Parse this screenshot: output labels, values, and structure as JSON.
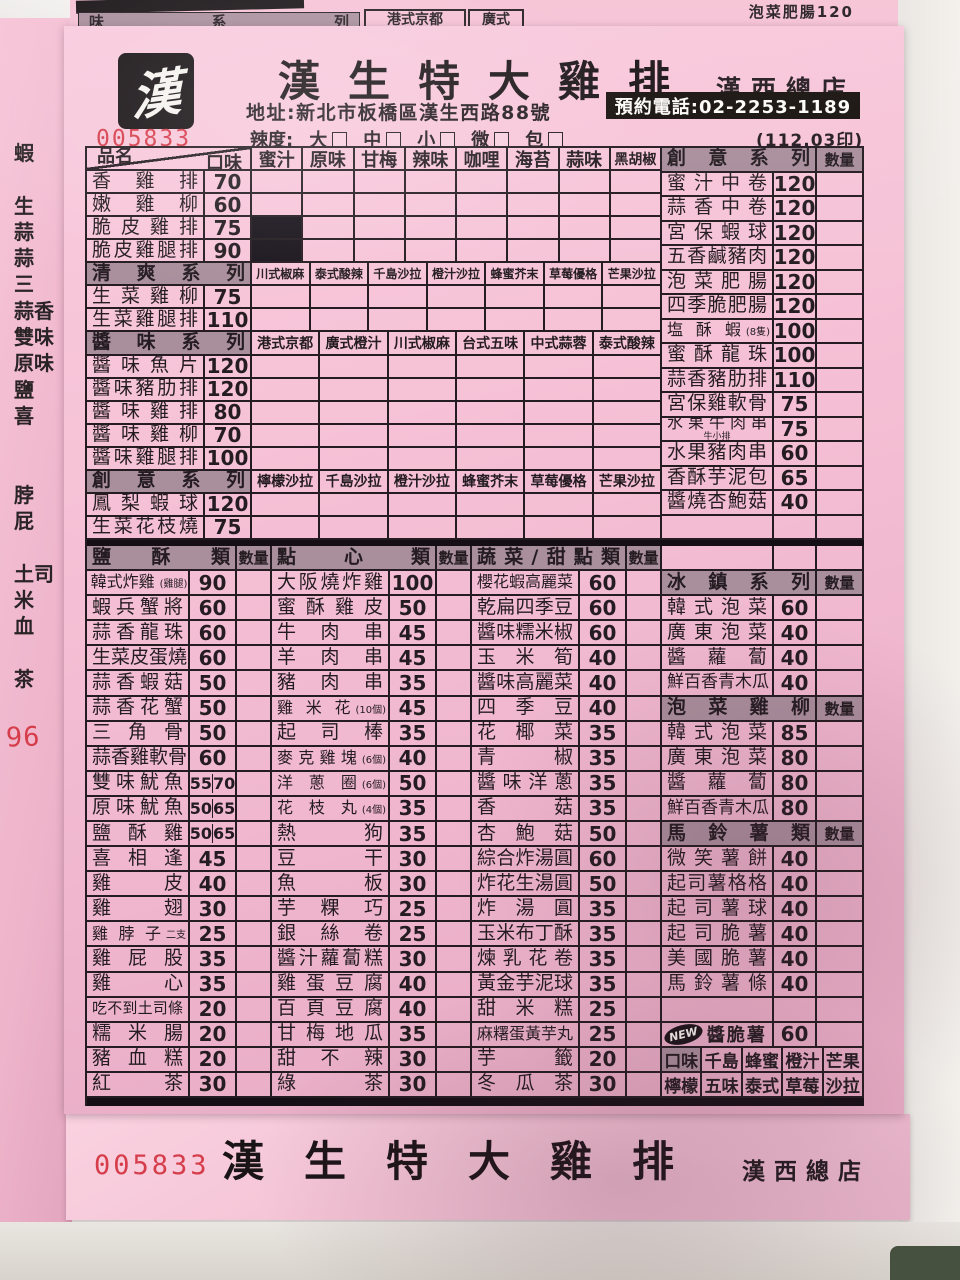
{
  "colors": {
    "sheet_pink": "#f4bed4",
    "header_gray": "#a98e9c",
    "ink": "#241c20",
    "serial_red": "#d63d4b"
  },
  "peek": {
    "left_chars": [
      "蝦",
      "",
      "生",
      "蒜",
      "蒜",
      "三",
      "蒜香",
      "雙味",
      "原味",
      "鹽",
      "喜",
      "",
      "",
      "脖",
      "屁",
      "",
      "土司",
      "米",
      "血",
      "",
      "茶"
    ],
    "red_number": "96",
    "top_gray": "味 系 列",
    "top_cell": "港式京都",
    "top_cell2": "廣式",
    "top_right": "泡菜肥腸120"
  },
  "header": {
    "logo_char": "漢",
    "title": "漢生特大雞排",
    "branch": "漢西總店",
    "address": "地址:新北市板橋區漢生西路88號",
    "phone": "預約電話:02-2253-1189",
    "spice_label": "辣度:",
    "spice_options": [
      "大",
      "中",
      "小",
      "微",
      "包"
    ],
    "print_code": "(112.03印)",
    "serial": "005833"
  },
  "top_table": {
    "name_header": "品名",
    "flavor_header": "口味",
    "flavors": [
      "蜜汁",
      "原味",
      "甘梅",
      "辣味",
      "咖哩",
      "海苔",
      "蒜味",
      "黑胡椒"
    ],
    "items": [
      {
        "name": "香雞排",
        "price": "70"
      },
      {
        "name": "嫩雞柳",
        "price": "60"
      },
      {
        "name": "脆皮雞排",
        "price": "75",
        "blocked": [
          0
        ]
      },
      {
        "name": "脆皮雞腿排",
        "price": "90",
        "blocked": [
          0
        ]
      }
    ],
    "sub_sections": [
      {
        "title": "清爽系列",
        "flavors": [
          "川式椒麻",
          "泰式酸辣",
          "千島沙拉",
          "橙汁沙拉",
          "蜂蜜芥末",
          "草莓優格",
          "芒果沙拉"
        ],
        "items": [
          {
            "name": "生菜雞柳",
            "price": "75"
          },
          {
            "name": "生菜雞腿排",
            "price": "110"
          }
        ]
      },
      {
        "title": "醬味系列",
        "flavors": [
          "港式京都",
          "廣式橙汁",
          "川式椒麻",
          "台式五味",
          "中式蒜蓉",
          "泰式酸辣"
        ],
        "items": [
          {
            "name": "醬味魚片",
            "price": "120"
          },
          {
            "name": "醬味豬肋排",
            "price": "120"
          },
          {
            "name": "醬味雞排",
            "price": "80"
          },
          {
            "name": "醬味雞柳",
            "price": "70"
          },
          {
            "name": "醬味雞腿排",
            "price": "100"
          }
        ]
      },
      {
        "title": "創意系列",
        "flavors": [
          "檸檬沙拉",
          "千島沙拉",
          "橙汁沙拉",
          "蜂蜜芥末",
          "草莓優格",
          "芒果沙拉"
        ],
        "items": [
          {
            "name": "鳳梨蝦球",
            "price": "120"
          },
          {
            "name": "生菜花枝燒",
            "price": "75"
          }
        ]
      }
    ]
  },
  "creative_panel": {
    "title": "創意系列",
    "qty_header": "數量",
    "items": [
      {
        "name": "蜜汁中卷",
        "price": "120"
      },
      {
        "name": "蒜香中卷",
        "price": "120"
      },
      {
        "name": "宮保蝦球",
        "price": "120"
      },
      {
        "name": "五香鹹豬肉",
        "price": "120"
      },
      {
        "name": "泡菜肥腸",
        "price": "120"
      },
      {
        "name": "四季脆肥腸",
        "price": "120"
      },
      {
        "name": "塩酥蝦",
        "note": "(8隻)",
        "price": "100"
      },
      {
        "name": "蜜酥龍珠",
        "price": "100"
      },
      {
        "name": "蒜香豬肋排",
        "price": "110"
      },
      {
        "name": "宮保雞軟骨",
        "price": "75"
      },
      {
        "name": "水果牛肉串",
        "sub": "牛小排",
        "price": "75"
      },
      {
        "name": "水果豬肉串",
        "price": "60"
      },
      {
        "name": "香酥芋泥包",
        "price": "65"
      },
      {
        "name": "醬燒杏鮑菇",
        "price": "40"
      }
    ]
  },
  "salt_section": {
    "title": "鹽酥類",
    "qty_header": "數量",
    "items": [
      {
        "name": "韓式炸雞",
        "note": "(雞腿)",
        "price": "90"
      },
      {
        "name": "蝦兵蟹將",
        "price": "60"
      },
      {
        "name": "蒜香龍珠",
        "price": "60"
      },
      {
        "name": "生菜皮蛋燒",
        "price": "60"
      },
      {
        "name": "蒜香蝦菇",
        "price": "50"
      },
      {
        "name": "蒜香花蟹",
        "price": "50"
      },
      {
        "name": "三角骨",
        "price": "50"
      },
      {
        "name": "蒜香雞軟骨",
        "price": "60"
      },
      {
        "name": "雙味魷魚",
        "price": "55",
        "price2": "70"
      },
      {
        "name": "原味魷魚",
        "price": "50",
        "price2": "65"
      },
      {
        "name": "鹽酥雞",
        "price": "50",
        "price2": "65"
      },
      {
        "name": "喜相逢",
        "price": "45"
      },
      {
        "name": "雞皮",
        "price": "40"
      },
      {
        "name": "雞翅",
        "price": "30"
      },
      {
        "name": "雞脖子",
        "note": "二支",
        "price": "25"
      },
      {
        "name": "雞屁股",
        "price": "35"
      },
      {
        "name": "雞心",
        "price": "35"
      },
      {
        "name": "吃不到土司條",
        "price": "20"
      },
      {
        "name": "糯米腸",
        "price": "20"
      },
      {
        "name": "豬血糕",
        "price": "20"
      },
      {
        "name": "紅茶",
        "price": "30"
      }
    ]
  },
  "snack_section": {
    "title": "點心類",
    "qty_header": "數量",
    "items": [
      {
        "name": "大阪燒炸雞",
        "price": "100"
      },
      {
        "name": "蜜酥雞皮",
        "price": "50"
      },
      {
        "name": "牛肉串",
        "price": "45"
      },
      {
        "name": "羊肉串",
        "price": "45"
      },
      {
        "name": "豬肉串",
        "price": "35"
      },
      {
        "name": "雞米花",
        "note": "(10個)",
        "price": "45"
      },
      {
        "name": "起司棒",
        "price": "35"
      },
      {
        "name": "麥克雞塊",
        "note": "(6個)",
        "price": "40"
      },
      {
        "name": "洋蔥圈",
        "note": "(6個)",
        "price": "50"
      },
      {
        "name": "花枝丸",
        "note": "(4個)",
        "price": "35"
      },
      {
        "name": "熱狗",
        "price": "35"
      },
      {
        "name": "豆干",
        "price": "30"
      },
      {
        "name": "魚板",
        "price": "30"
      },
      {
        "name": "芋粿巧",
        "price": "25"
      },
      {
        "name": "銀絲卷",
        "price": "25"
      },
      {
        "name": "醬汁蘿蔔糕",
        "price": "30"
      },
      {
        "name": "雞蛋豆腐",
        "price": "40"
      },
      {
        "name": "百頁豆腐",
        "price": "40"
      },
      {
        "name": "甘梅地瓜",
        "price": "35"
      },
      {
        "name": "甜不辣",
        "price": "30"
      },
      {
        "name": "綠茶",
        "price": "30"
      }
    ]
  },
  "veg_section": {
    "title": "蔬菜/甜點類",
    "qty_header": "數量",
    "items": [
      {
        "name": "櫻花蝦高麗菜",
        "price": "60"
      },
      {
        "name": "乾扁四季豆",
        "price": "60"
      },
      {
        "name": "醬味糯米椒",
        "price": "60"
      },
      {
        "name": "玉米筍",
        "price": "40"
      },
      {
        "name": "醬味高麗菜",
        "price": "40"
      },
      {
        "name": "四季豆",
        "price": "40"
      },
      {
        "name": "花椰菜",
        "price": "35"
      },
      {
        "name": "青椒",
        "price": "35"
      },
      {
        "name": "醬味洋蔥",
        "price": "35"
      },
      {
        "name": "香菇",
        "price": "35"
      },
      {
        "name": "杏鮑菇",
        "price": "50"
      },
      {
        "name": "綜合炸湯圓",
        "price": "60"
      },
      {
        "name": "炸花生湯圓",
        "price": "50"
      },
      {
        "name": "炸湯圓",
        "price": "35"
      },
      {
        "name": "玉米布丁酥",
        "price": "35"
      },
      {
        "name": "煉乳花卷",
        "price": "35"
      },
      {
        "name": "黃金芋泥球",
        "price": "35"
      },
      {
        "name": "甜米糕",
        "price": "25"
      },
      {
        "name": "麻糬蛋黃芋丸",
        "price": "25"
      },
      {
        "name": "芋籤",
        "price": "20"
      },
      {
        "name": "冬瓜茶",
        "price": "30"
      }
    ]
  },
  "right_bottom": {
    "iced": {
      "title": "冰鎮系列",
      "qty_header": "數量",
      "items": [
        {
          "name": "韓式泡菜",
          "price": "60"
        },
        {
          "name": "廣東泡菜",
          "price": "40"
        },
        {
          "name": "醬蘿蔔",
          "price": "40"
        },
        {
          "name": "鮮百香青木瓜",
          "price": "40"
        }
      ]
    },
    "kimchi_chicken": {
      "title": "泡菜雞柳",
      "qty_header": "數量",
      "items": [
        {
          "name": "韓式泡菜",
          "price": "85"
        },
        {
          "name": "廣東泡菜",
          "price": "80"
        },
        {
          "name": "醬蘿蔔",
          "price": "80"
        },
        {
          "name": "鮮百香青木瓜",
          "price": "80"
        }
      ]
    },
    "potato": {
      "title": "馬鈴薯類",
      "qty_header": "數量",
      "items": [
        {
          "name": "微笑薯餅",
          "price": "40"
        },
        {
          "name": "起司薯格格",
          "price": "40"
        },
        {
          "name": "起司薯球",
          "price": "40"
        },
        {
          "name": "起司脆薯",
          "price": "40"
        },
        {
          "name": "美國脆薯",
          "price": "40"
        },
        {
          "name": "馬鈴薯條",
          "price": "40"
        }
      ]
    },
    "new_item": {
      "badge": "NEW",
      "name": "醬脆薯",
      "price": "60"
    },
    "flavor_note": {
      "label": "口味",
      "row1": [
        "千島",
        "蜂蜜",
        "橙汁",
        "芒果"
      ],
      "row2": [
        "檸檬",
        "五味",
        "泰式",
        "草莓",
        "沙拉"
      ]
    }
  },
  "footer": {
    "serial": "005833",
    "title": "漢生特大雞排",
    "branch": "漢西總店"
  }
}
